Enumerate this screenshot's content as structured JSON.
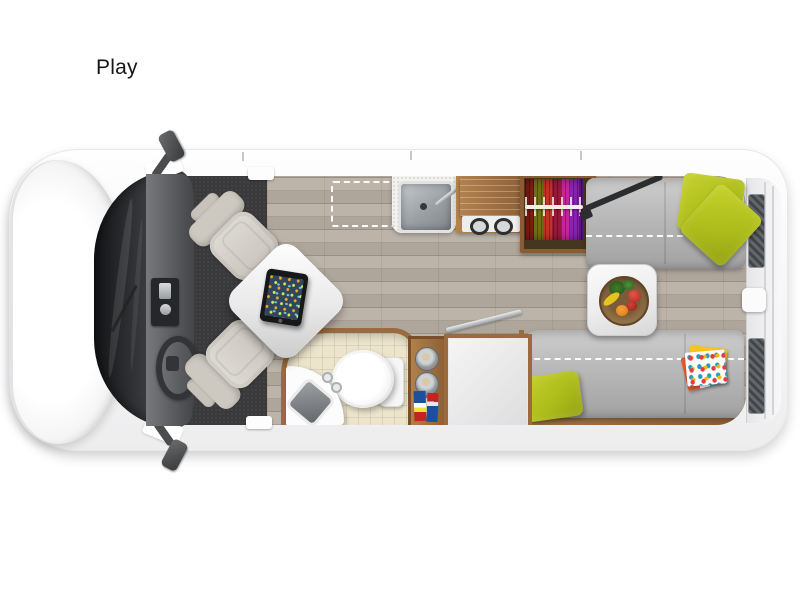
{
  "page": {
    "background": "#ffffff"
  },
  "floorplan": {
    "model_label": "Play",
    "view": "overhead-floorplan-class-b-camper-van",
    "colors": {
      "body_white": "#f7f7f8",
      "accent_lime": "#b3c21d",
      "sofa_gray": "#b5b5b5",
      "wood_floor": "#b7aea3",
      "wood_trim": "#9a6b3f",
      "bath_tile": "#ece5cc",
      "cab_mat": "#3a3a3c",
      "stainless": "#c3c7ca",
      "wardrobe_clothes": [
        "#7d1f16",
        "#6e6e1c",
        "#c03422",
        "#921c38",
        "#c2269b",
        "#8d24b0",
        "#5f1d93"
      ]
    },
    "items": [
      {
        "name": "van-hood"
      },
      {
        "name": "windshield"
      },
      {
        "name": "side-mirror-top"
      },
      {
        "name": "side-mirror-bottom"
      },
      {
        "name": "dashboard"
      },
      {
        "name": "steering-wheel"
      },
      {
        "name": "driver-swivel-seat"
      },
      {
        "name": "passenger-swivel-seat"
      },
      {
        "name": "pedestal-table"
      },
      {
        "name": "tablet"
      },
      {
        "name": "galley-sink"
      },
      {
        "name": "faucet"
      },
      {
        "name": "two-burner-cooktop"
      },
      {
        "name": "cooktop-flip-cover"
      },
      {
        "name": "wardrobe-hanging-clothes"
      },
      {
        "name": "sofa-top"
      },
      {
        "name": "sofa-bottom"
      },
      {
        "name": "bed-conversion-outline-top"
      },
      {
        "name": "bed-conversion-outline-bottom"
      },
      {
        "name": "floor-option-outline"
      },
      {
        "name": "dinette-table"
      },
      {
        "name": "fruit-bowl"
      },
      {
        "name": "throw-pillow-1"
      },
      {
        "name": "throw-pillow-2"
      },
      {
        "name": "throw-pillow-3"
      },
      {
        "name": "magazines"
      },
      {
        "name": "bathroom"
      },
      {
        "name": "toilet"
      },
      {
        "name": "corner-sink"
      },
      {
        "name": "storage-shelf-canisters"
      },
      {
        "name": "books"
      },
      {
        "name": "storage-cabinet"
      },
      {
        "name": "table-pole"
      },
      {
        "name": "rear-doors"
      },
      {
        "name": "wood-plank-floor"
      }
    ]
  }
}
